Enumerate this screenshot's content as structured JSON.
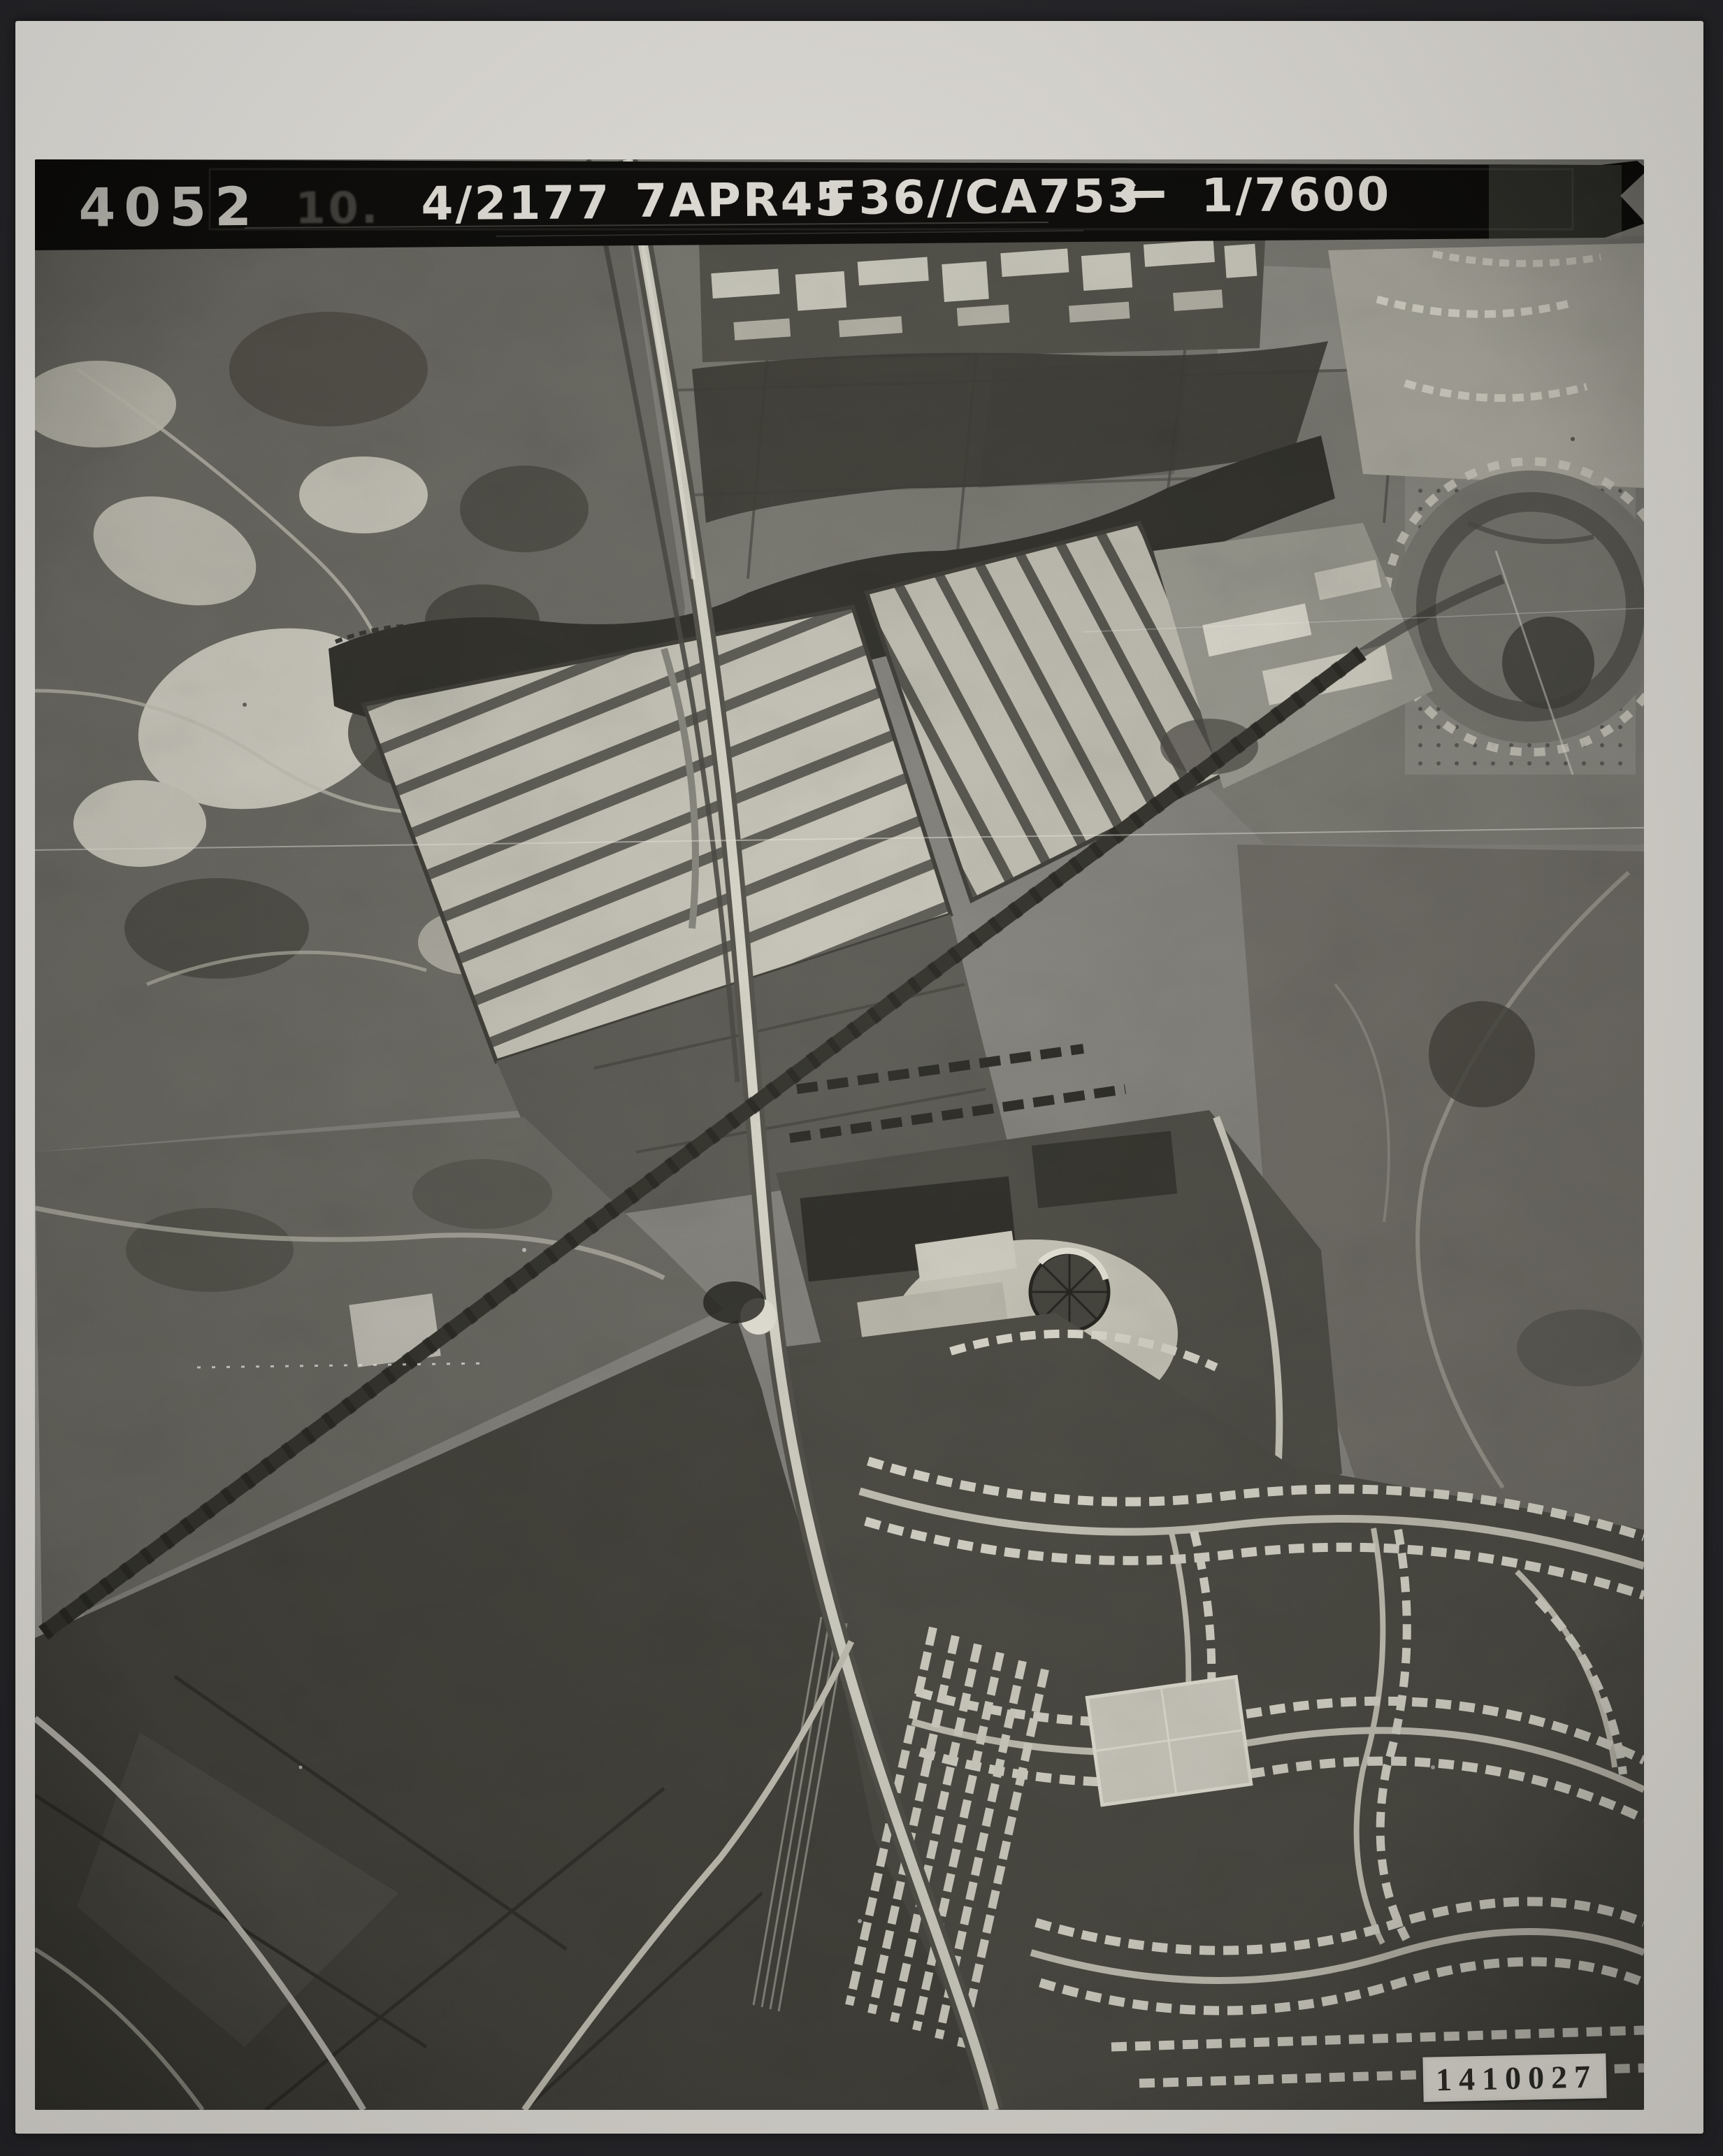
{
  "scan": {
    "background_color": "#26262a",
    "paper_color": "#ebe8e1"
  },
  "photo": {
    "description": "Black-and-white vertical aerial reconnaissance photograph: heathland and quarries upper left, fields and a circular earthwork upper right, striped market-garden plots in the centre, a main road and railway running diagonally top to bottom, a tree-lined avenue crossing it, gas works with two round gasometers at centre, dark farmland lower left and dense terraced housing estates lower right.",
    "base_tone": "#87867e"
  },
  "header_strip": {
    "strip_color": "#0c0b09",
    "text_color": "#f3f1e8",
    "frame_number": "4052",
    "faint_mark": "10.",
    "sortie_reference": "4/2177",
    "date": "7APR45",
    "camera_sortie_code": "F36//CA753",
    "arrow": "←",
    "scale": "1/7600"
  },
  "archive_label": {
    "background_color": "#dcd9d0",
    "text_color": "#2a2922",
    "left_number": "141",
    "right_number": "0027"
  }
}
